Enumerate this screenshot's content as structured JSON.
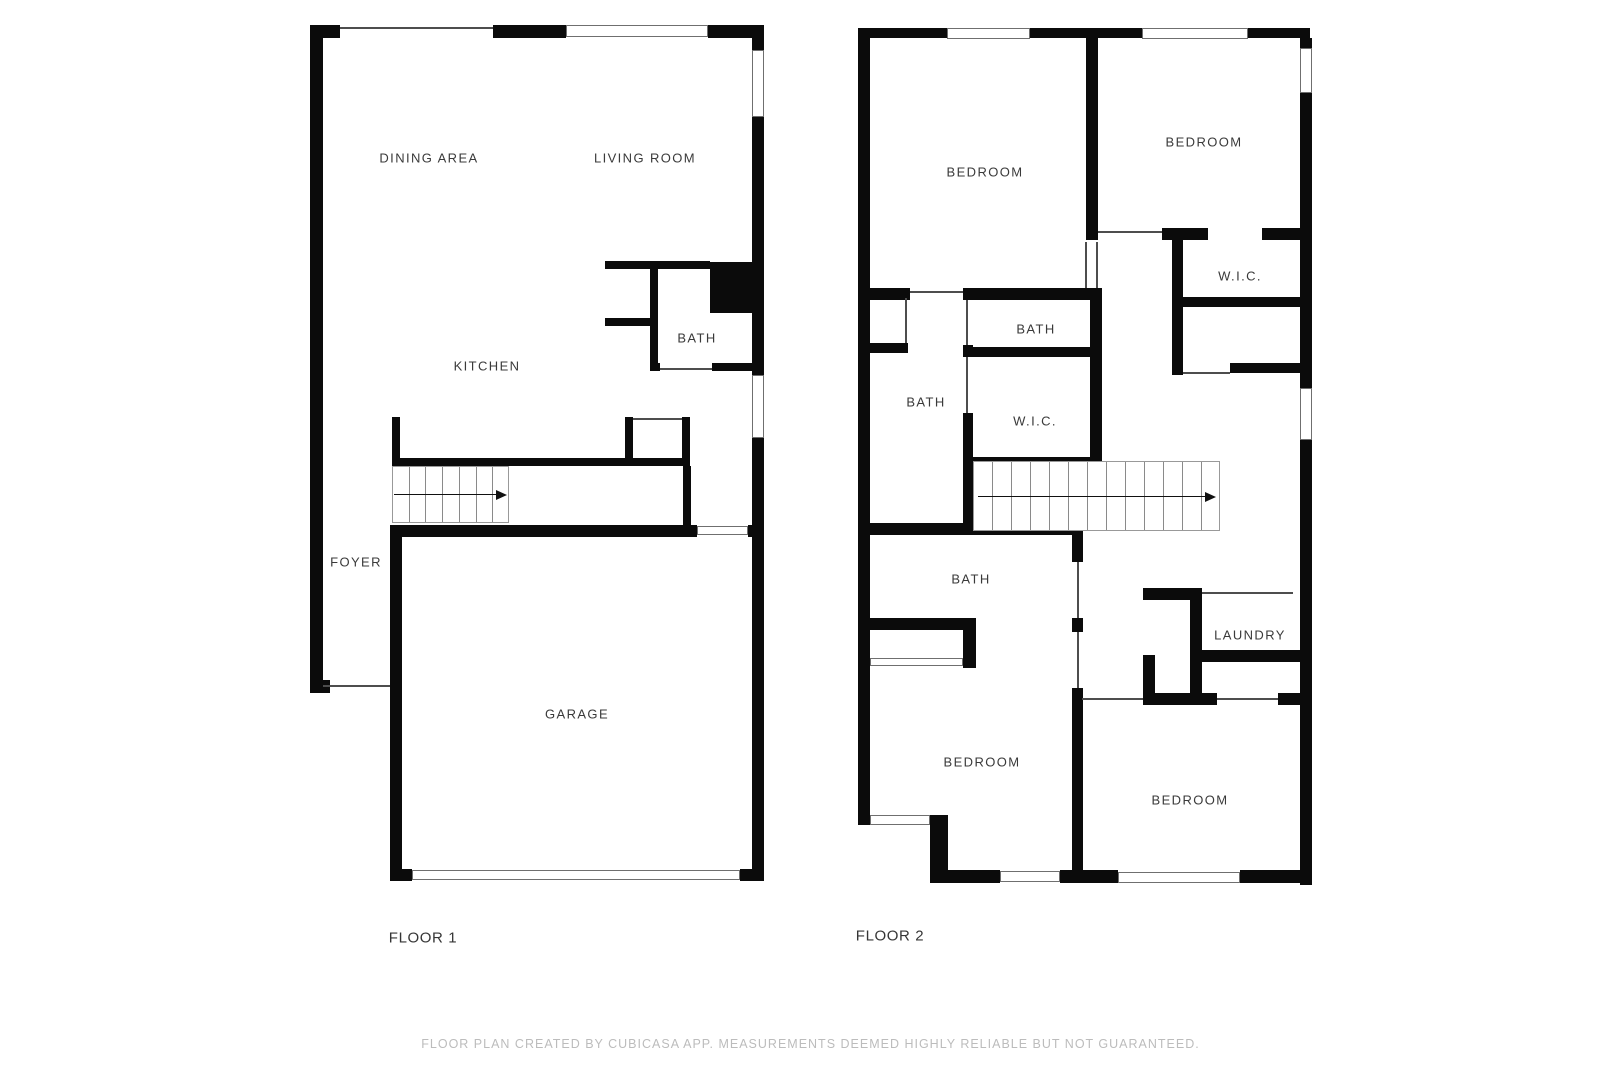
{
  "footer": {
    "text": "FLOOR PLAN CREATED BY CUBICASA APP. MEASUREMENTS DEEMED HIGHLY RELIABLE BUT NOT GUARANTEED."
  },
  "colors": {
    "wall": "#0b0b0b",
    "thin_line": "#4d4d4d",
    "opening_border": "#6f6f6f",
    "stair_border": "#999999",
    "stair_tread": "#8a8a8a",
    "arrow": "#111111",
    "room_label": "#3a3a3a",
    "floor_title": "#353535",
    "footer_text": "#bcbcbc"
  },
  "floors": [
    {
      "title": "FLOOR 1",
      "title_pos": {
        "x": 423,
        "y": 938
      },
      "rooms": [
        {
          "label": "DINING AREA",
          "x": 429,
          "y": 158
        },
        {
          "label": "LIVING ROOM",
          "x": 645,
          "y": 158
        },
        {
          "label": "BATH",
          "x": 697,
          "y": 338
        },
        {
          "label": "KITCHEN",
          "x": 487,
          "y": 366
        },
        {
          "label": "FOYER",
          "x": 356,
          "y": 562
        },
        {
          "label": "GARAGE",
          "x": 577,
          "y": 714
        }
      ],
      "walls": [
        [
          310,
          25,
          13,
          668
        ],
        [
          310,
          25,
          30,
          13
        ],
        [
          493,
          25,
          73,
          13
        ],
        [
          708,
          25,
          56,
          13
        ],
        [
          752,
          38,
          12,
          12
        ],
        [
          752,
          117,
          12,
          145
        ],
        [
          710,
          262,
          54,
          51
        ],
        [
          752,
          313,
          12,
          62
        ],
        [
          752,
          438,
          12,
          443
        ],
        [
          605,
          261,
          105,
          8
        ],
        [
          650,
          261,
          8,
          102
        ],
        [
          605,
          318,
          45,
          8
        ],
        [
          650,
          363,
          10,
          8
        ],
        [
          712,
          363,
          41,
          8
        ],
        [
          392,
          458,
          298,
          8
        ],
        [
          392,
          417,
          8,
          41
        ],
        [
          625,
          417,
          8,
          41
        ],
        [
          682,
          417,
          8,
          41
        ],
        [
          392,
          525,
          305,
          12
        ],
        [
          748,
          525,
          16,
          12
        ],
        [
          683,
          466,
          8,
          59
        ],
        [
          390,
          525,
          12,
          356
        ],
        [
          310,
          680,
          20,
          13
        ],
        [
          390,
          869,
          22,
          12
        ],
        [
          740,
          869,
          24,
          12
        ]
      ],
      "thin_lines": [
        [
          340,
          27,
          153,
          2
        ],
        [
          660,
          368,
          52,
          2
        ],
        [
          633,
          418,
          49,
          2
        ],
        [
          323,
          685,
          67,
          2
        ]
      ],
      "openings": [
        [
          566,
          25,
          142,
          12
        ],
        [
          752,
          50,
          12,
          67
        ],
        [
          752,
          375,
          12,
          63
        ],
        [
          697,
          526,
          51,
          9
        ],
        [
          412,
          870,
          328,
          10
        ]
      ],
      "stairs": {
        "x": 392,
        "y": 466,
        "w": 117,
        "h": 57,
        "treads": 6,
        "arrow": {
          "x1": 394,
          "x2": 496,
          "y": 494
        }
      }
    },
    {
      "title": "FLOOR 2",
      "title_pos": {
        "x": 890,
        "y": 936
      },
      "rooms": [
        {
          "label": "BEDROOM",
          "x": 985,
          "y": 172
        },
        {
          "label": "BEDROOM",
          "x": 1204,
          "y": 142
        },
        {
          "label": "W.I.C.",
          "x": 1240,
          "y": 276
        },
        {
          "label": "BATH",
          "x": 1036,
          "y": 329
        },
        {
          "label": "BATH",
          "x": 926,
          "y": 402
        },
        {
          "label": "W.I.C.",
          "x": 1035,
          "y": 421
        },
        {
          "label": "BATH",
          "x": 971,
          "y": 579
        },
        {
          "label": "LAUNDRY",
          "x": 1250,
          "y": 635
        },
        {
          "label": "BEDROOM",
          "x": 982,
          "y": 762
        },
        {
          "label": "BEDROOM",
          "x": 1190,
          "y": 800
        }
      ],
      "walls": [
        [
          858,
          28,
          12,
          797
        ],
        [
          858,
          28,
          89,
          10
        ],
        [
          1030,
          28,
          112,
          10
        ],
        [
          1248,
          28,
          62,
          10
        ],
        [
          1300,
          38,
          12,
          10
        ],
        [
          1300,
          93,
          12,
          295
        ],
        [
          1300,
          440,
          12,
          445
        ],
        [
          1086,
          38,
          12,
          202
        ],
        [
          1090,
          288,
          12,
          179
        ],
        [
          858,
          288,
          52,
          12
        ],
        [
          963,
          288,
          137,
          12
        ],
        [
          1162,
          228,
          46,
          12
        ],
        [
          1262,
          228,
          38,
          12
        ],
        [
          1172,
          233,
          11,
          142
        ],
        [
          1183,
          297,
          117,
          10
        ],
        [
          1230,
          363,
          77,
          10
        ],
        [
          870,
          343,
          38,
          10
        ],
        [
          963,
          345,
          10,
          12
        ],
        [
          963,
          413,
          10,
          122
        ],
        [
          963,
          347,
          139,
          10
        ],
        [
          963,
          457,
          139,
          10
        ],
        [
          858,
          523,
          215,
          12
        ],
        [
          1072,
          523,
          11,
          39
        ],
        [
          1072,
          618,
          11,
          14
        ],
        [
          1072,
          688,
          11,
          184
        ],
        [
          858,
          618,
          118,
          12
        ],
        [
          963,
          630,
          13,
          38
        ],
        [
          1143,
          588,
          59,
          12
        ],
        [
          1190,
          588,
          12,
          117
        ],
        [
          1202,
          650,
          98,
          12
        ],
        [
          1143,
          655,
          12,
          50
        ],
        [
          1143,
          693,
          74,
          12
        ],
        [
          1278,
          693,
          22,
          12
        ],
        [
          930,
          815,
          18,
          67
        ],
        [
          930,
          870,
          70,
          13
        ],
        [
          1060,
          870,
          58,
          13
        ],
        [
          1240,
          870,
          70,
          13
        ]
      ],
      "thin_lines": [
        [
          910,
          291,
          53,
          2
        ],
        [
          1098,
          231,
          64,
          2
        ],
        [
          905,
          298,
          2,
          45
        ],
        [
          966,
          300,
          2,
          45
        ],
        [
          966,
          357,
          2,
          56
        ],
        [
          1085,
          242,
          2,
          46
        ],
        [
          1096,
          242,
          2,
          46
        ],
        [
          1183,
          372,
          47,
          2
        ],
        [
          1202,
          592,
          91,
          2
        ],
        [
          1077,
          562,
          2,
          56
        ],
        [
          1077,
          632,
          2,
          56
        ],
        [
          1082,
          698,
          61,
          2
        ],
        [
          1217,
          698,
          61,
          2
        ]
      ],
      "openings": [
        [
          947,
          28,
          83,
          11
        ],
        [
          1142,
          28,
          106,
          11
        ],
        [
          1300,
          48,
          12,
          45
        ],
        [
          1300,
          388,
          12,
          52
        ],
        [
          870,
          815,
          60,
          10
        ],
        [
          1000,
          871,
          60,
          11
        ],
        [
          1118,
          872,
          122,
          11
        ],
        [
          870,
          658,
          93,
          8
        ]
      ],
      "stairs": {
        "x": 973,
        "y": 461,
        "w": 247,
        "h": 70,
        "treads": 12,
        "arrow": {
          "x1": 978,
          "x2": 1205,
          "y": 496
        }
      }
    }
  ]
}
